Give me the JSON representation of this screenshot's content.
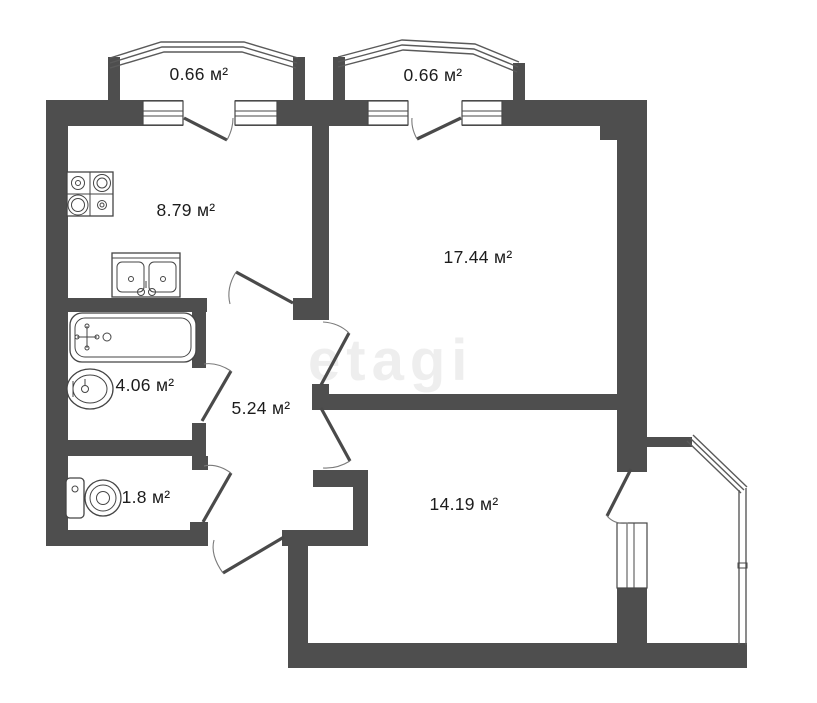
{
  "document": {
    "type": "apartment-floor-plan",
    "watermark": "etagi"
  },
  "rooms": {
    "balcony_left": {
      "label": "0.66 м²"
    },
    "balcony_right": {
      "label": "0.66 м²"
    },
    "kitchen": {
      "label": "8.79 м²"
    },
    "living_room": {
      "label": "17.44 м²"
    },
    "bathroom": {
      "label": "4.06 м²"
    },
    "hallway": {
      "label": "5.24 м²"
    },
    "toilet": {
      "label": "1.8 м²"
    },
    "bedroom": {
      "label": "14.19 м²"
    }
  },
  "colors": {
    "wall": "#4e4e4e",
    "fixture_line": "#454545",
    "background": "#ffffff",
    "label_text": "#1c1c1c",
    "watermark": "#ececec"
  }
}
